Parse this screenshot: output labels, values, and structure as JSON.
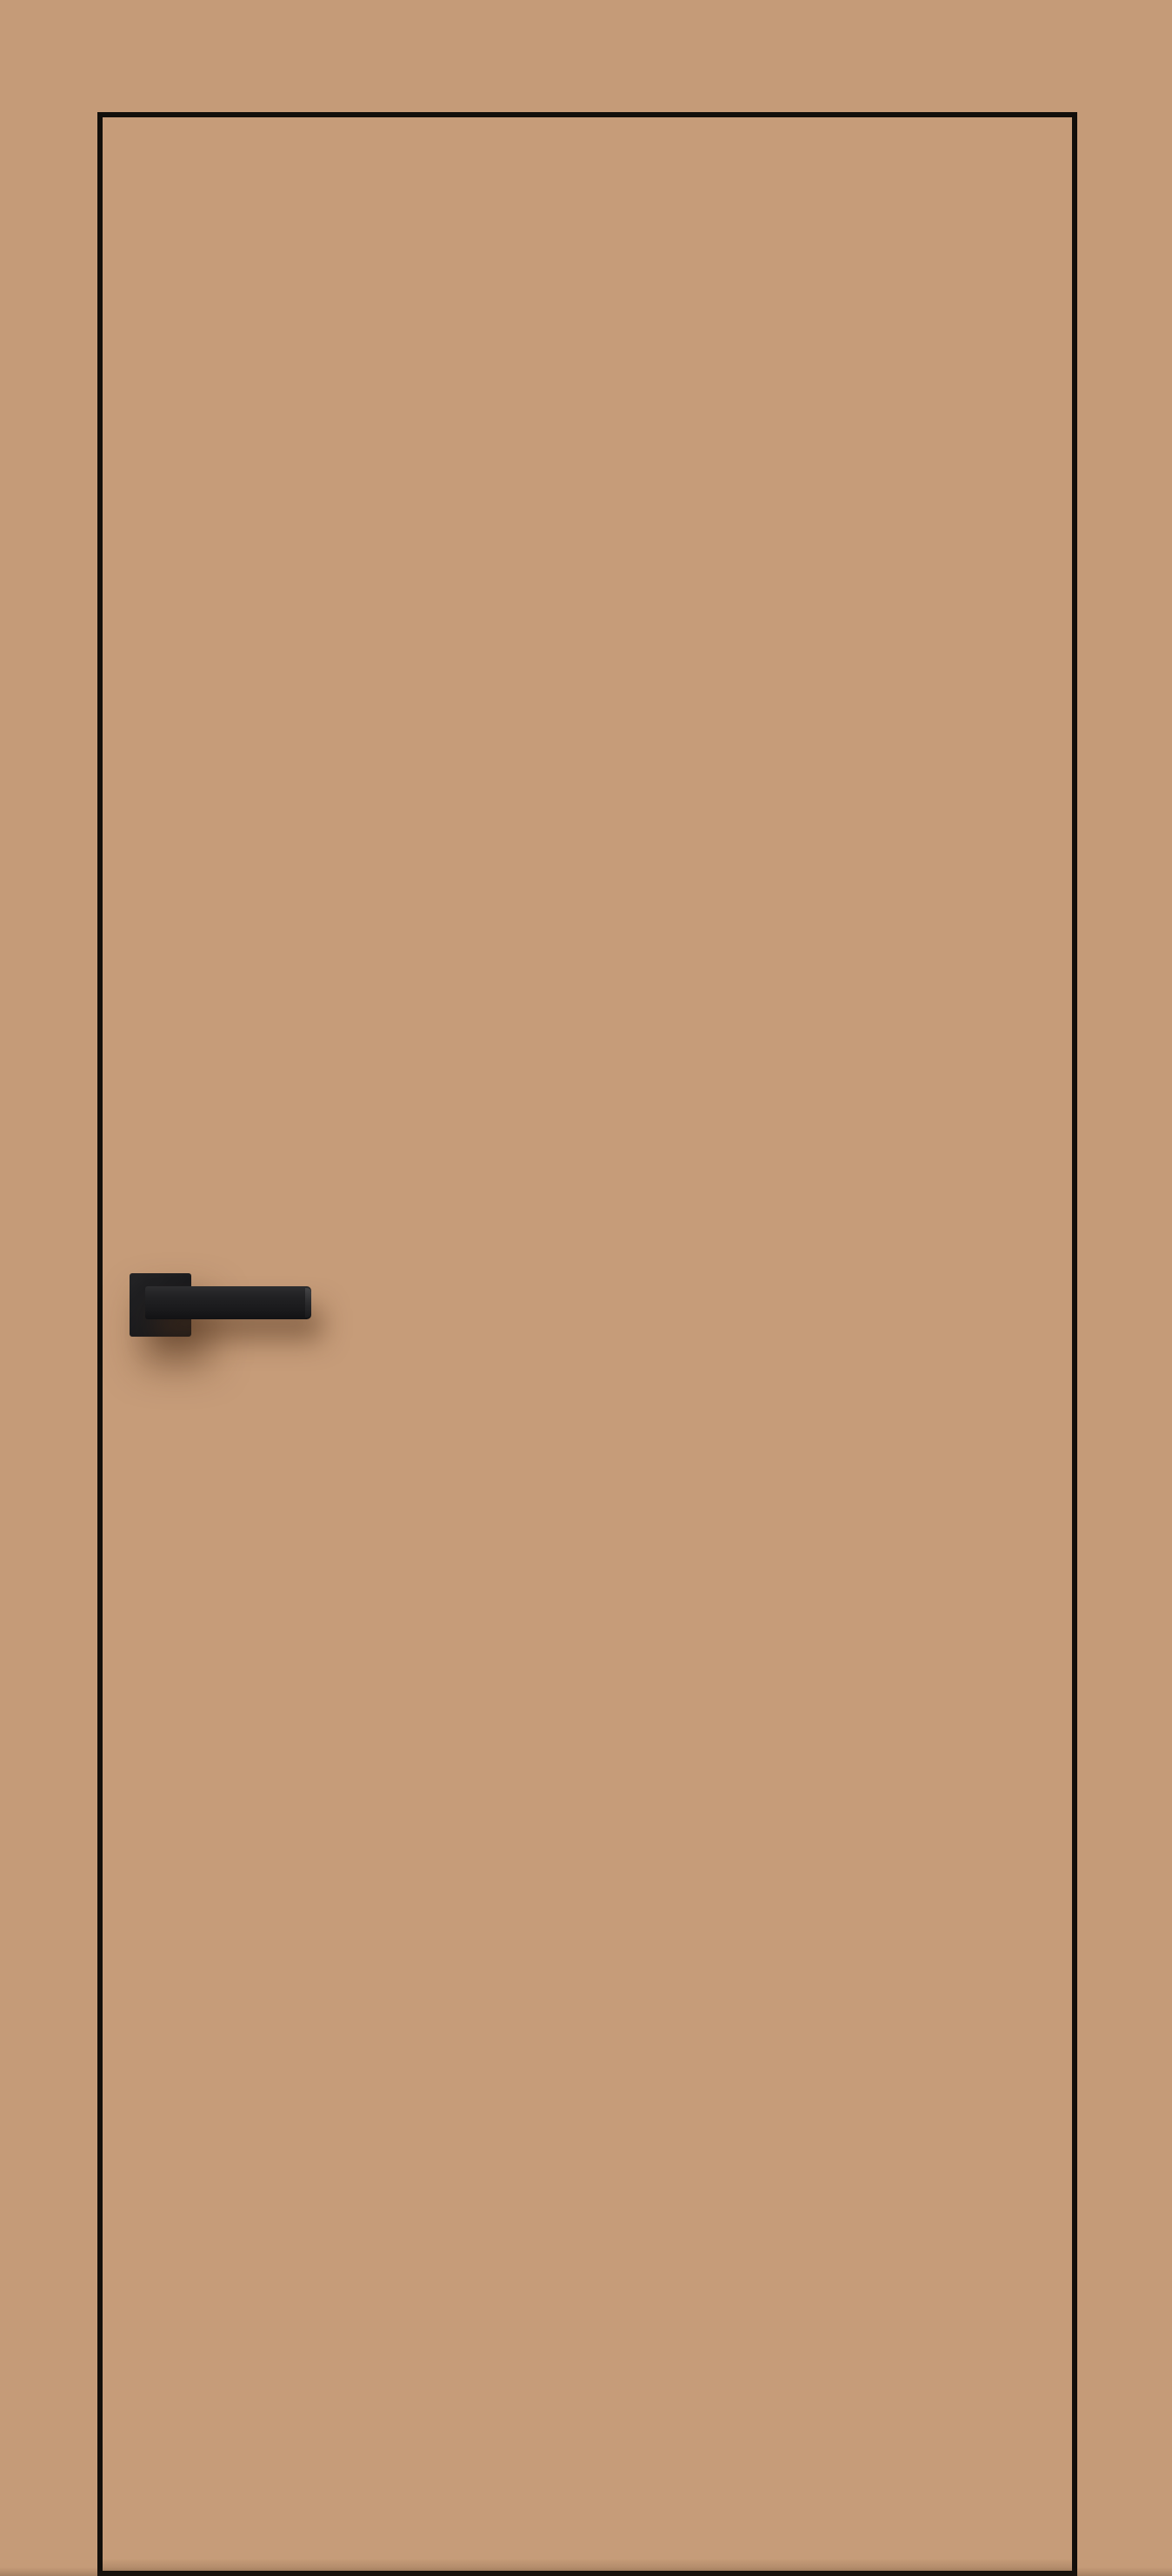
{
  "scene": {
    "description": "Product render of a flush interior door in a beige/cappuccino finish with thin black edge trim, mounted flush in a wall of the same beige color. A matte black square-rose lever handle is on the left side of the leaf, slightly above vertical center, casting a soft brown shadow down and to the right.",
    "door": {
      "label": "door-leaf",
      "finish": "flat beige, untextured",
      "edge_trim": "thin black edge line on top, left, right and bottom",
      "handle_side": "left",
      "opening": "outward-facing flat leaf, no glazing, no hinges visible"
    },
    "handle": {
      "label": "door-handle",
      "type": "square-rose lever handle",
      "finish": "matte black",
      "parts": [
        "square rose plate",
        "straight rectangular lever pointing right"
      ]
    }
  },
  "colors": {
    "wall": "#c59b78",
    "door": "#c69c79",
    "edge": "#120f0b",
    "handle": "#1d1d1f",
    "shadow": "rgba(80,50,28,0.5)"
  }
}
